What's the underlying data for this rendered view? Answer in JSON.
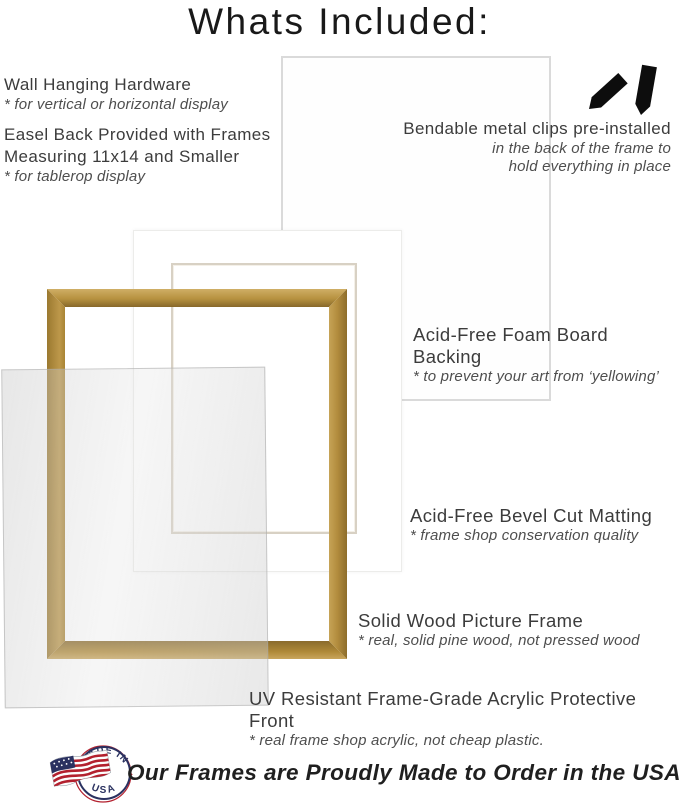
{
  "title": "Whats Included:",
  "sections": {
    "wall": {
      "heading": "Wall Hanging Hardware",
      "sub": "* for vertical or horizontal display"
    },
    "easel": {
      "line1": "Easel Back Provided with Frames",
      "line2": "Measuring 11x14 and Smaller",
      "sub": "* for tablerop display"
    },
    "clips": {
      "heading": "Bendable metal clips pre-installed",
      "sub1": "in the back of the frame to",
      "sub2": "hold everything in place"
    },
    "foam": {
      "heading": "Acid-Free Foam Board Backing",
      "sub": "* to prevent your art from ‘yellowing’"
    },
    "matting": {
      "heading": "Acid-Free Bevel Cut Matting",
      "sub": "* frame shop conservation quality"
    },
    "wood": {
      "heading": "Solid Wood Picture Frame",
      "sub": "* real, solid pine wood, not pressed wood"
    },
    "acrylic": {
      "heading": "UV Resistant Frame-Grade Acrylic Protective Front",
      "sub": "* real frame shop acrylic, not cheap plastic."
    }
  },
  "footer": {
    "text": "Our Frames are Proudly Made to Order in the USA",
    "badge_top": "MADE IN",
    "badge_bottom": "USA"
  },
  "colors": {
    "gold_light": "#c8a55c",
    "gold_mid": "#b08b42",
    "gold_dark": "#8a6a2a",
    "navy": "#2a3160",
    "red": "#b3202e",
    "heading_text": "#3c3c3c",
    "sub_text": "#4e4e4e"
  }
}
